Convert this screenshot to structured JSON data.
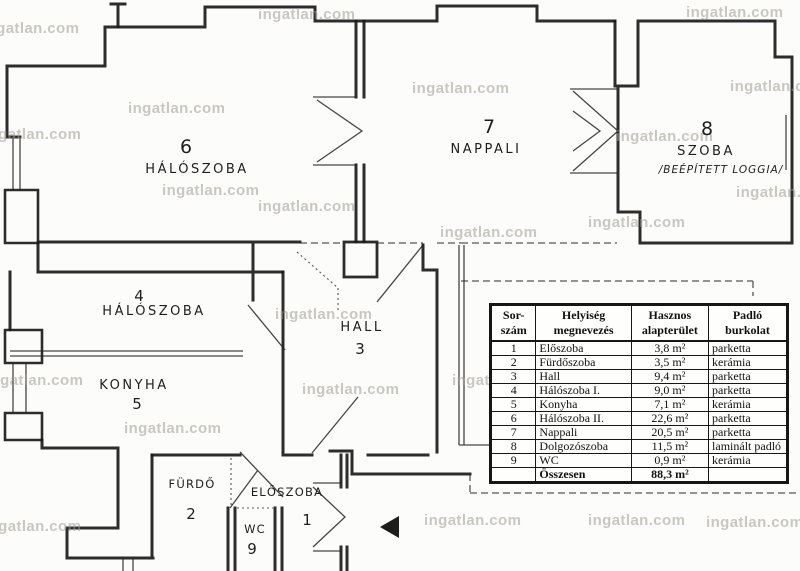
{
  "watermarks": {
    "text": "ingatlan.com",
    "positions": [
      [
        -18,
        20
      ],
      [
        258,
        6
      ],
      [
        686,
        4
      ],
      [
        128,
        100
      ],
      [
        412,
        80
      ],
      [
        730,
        78
      ],
      [
        -16,
        126
      ],
      [
        616,
        128
      ],
      [
        162,
        182
      ],
      [
        258,
        198
      ],
      [
        736,
        184
      ],
      [
        588,
        214
      ],
      [
        440,
        224
      ],
      [
        275,
        306
      ],
      [
        452,
        372
      ],
      [
        -14,
        372
      ],
      [
        302,
        381
      ],
      [
        600,
        414
      ],
      [
        124,
        420
      ],
      [
        -16,
        518
      ],
      [
        424,
        512
      ],
      [
        588,
        512
      ],
      [
        706,
        514
      ]
    ]
  },
  "rooms": [
    {
      "num": "6",
      "label": "HÁLÓSZOBA"
    },
    {
      "num": "7",
      "label": "NAPPALI"
    },
    {
      "num": "8",
      "label": "SZOBA",
      "sub": "/BEÉPÍTETT LOGGIA/"
    },
    {
      "num": "4",
      "label": "HÁLÓSZOBA"
    },
    {
      "num": "3",
      "label": "HALL"
    },
    {
      "num": "5",
      "label": "KONYHA"
    },
    {
      "num": "2",
      "label": "FÜRDŐ"
    },
    {
      "num": "1",
      "label": "ELŐSZOBA"
    },
    {
      "num": "9",
      "label": "WC"
    }
  ],
  "table": {
    "headers": [
      "Sor-\nszám",
      "Helyiség\nmegnevezés",
      "Hasznos\nalapterület",
      "Padló\nburkolat"
    ],
    "rows": [
      {
        "no": "1",
        "name": "Előszoba",
        "area": "3,8 m²",
        "floor": "parketta"
      },
      {
        "no": "2",
        "name": "Fürdőszoba",
        "area": "3,5 m²",
        "floor": "kerámia"
      },
      {
        "no": "3",
        "name": "Hall",
        "area": "9,4 m²",
        "floor": "parketta"
      },
      {
        "no": "4",
        "name": "Hálószoba I.",
        "area": "9,0 m²",
        "floor": "parketta"
      },
      {
        "no": "5",
        "name": "Konyha",
        "area": "7,1 m²",
        "floor": "kerámia"
      },
      {
        "no": "6",
        "name": "Hálószoba II.",
        "area": "22,6 m²",
        "floor": "parketta"
      },
      {
        "no": "7",
        "name": "Nappali",
        "area": "20,5 m²",
        "floor": "parketta"
      },
      {
        "no": "8",
        "name": "Dolgozószoba",
        "area": "11,5 m²",
        "floor": "laminált padló"
      },
      {
        "no": "9",
        "name": "WC",
        "area": "0,9 m²",
        "floor": "kerámia"
      }
    ],
    "total": {
      "label": "Összesen",
      "area": "88,3 m²"
    }
  },
  "icons": {
    "entrance_arrow": "left-solid-triangle"
  }
}
